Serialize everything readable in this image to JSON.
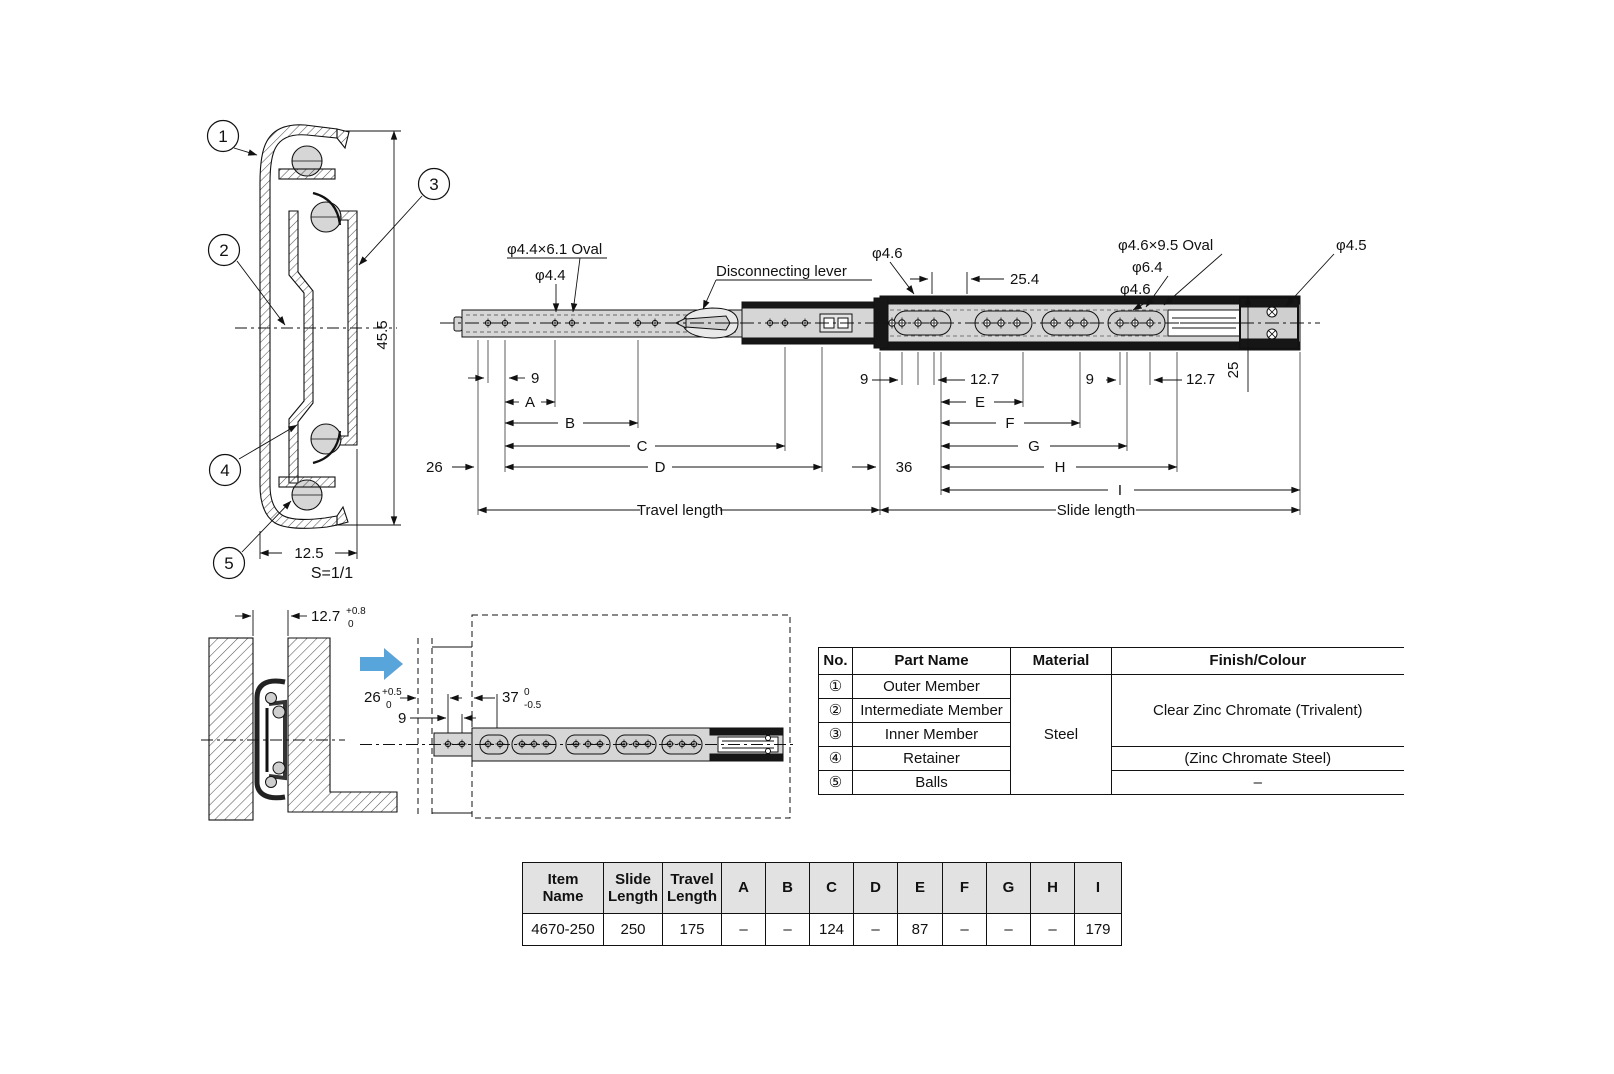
{
  "cross_section": {
    "balloons": [
      "1",
      "2",
      "3",
      "4",
      "5"
    ],
    "height_dim": "45.5",
    "width_dim": "12.5",
    "scale_note": "S=1/1"
  },
  "side_view": {
    "labels": {
      "oval_left": "φ4.4×6.1 Oval",
      "dia_left": "φ4.4",
      "lever": "Disconnecting lever",
      "dia_mid": "φ4.6",
      "pitch_mid": "25.4",
      "oval_right": "φ4.6×9.5 Oval",
      "dia_right_big": "φ6.4",
      "dia_right": "φ4.6",
      "dia_end": "φ4.5",
      "height_right": "25"
    },
    "left_dims": {
      "hole_offset": "9",
      "a": "A",
      "b": "B",
      "c": "C",
      "d": "D",
      "end_offset": "26",
      "total": "Travel length"
    },
    "right_dims": {
      "hole_offset": "9",
      "hole_pitch": "12.7",
      "e": "E",
      "f": "F",
      "g": "G",
      "h": "H",
      "end_offset": "36",
      "hole_offset2": "9",
      "hole_pitch2": "12.7",
      "i": "I",
      "total": "Slide length"
    }
  },
  "install_view": {
    "width_dim": "12.7",
    "tol_plus": "+0.8",
    "tol_minus": "0"
  },
  "compressed_view": {
    "depth_dim": "26",
    "depth_plus": "+0.5",
    "depth_minus": "0",
    "hole_offset": "9",
    "length_dim": "37",
    "length_plus": "0",
    "length_minus": "-0.5"
  },
  "parts_table": {
    "headers": [
      "No.",
      "Part Name",
      "Material",
      "Finish/Colour"
    ],
    "rows": [
      {
        "no": "①",
        "name": "Outer Member"
      },
      {
        "no": "②",
        "name": "Intermediate Member"
      },
      {
        "no": "③",
        "name": "Inner Member"
      },
      {
        "no": "④",
        "name": "Retainer"
      },
      {
        "no": "⑤",
        "name": "Balls"
      }
    ],
    "material": "Steel",
    "finish_1_3": "Clear Zinc Chromate (Trivalent)",
    "finish_4": "(Zinc Chromate Steel)",
    "finish_5": "–"
  },
  "dim_table": {
    "headers": [
      "Item Name",
      "Slide\nLength",
      "Travel\nLength",
      "A",
      "B",
      "C",
      "D",
      "E",
      "F",
      "G",
      "H",
      "I"
    ],
    "row": [
      "4670-250",
      "250",
      "175",
      "–",
      "–",
      "124",
      "–",
      "87",
      "–",
      "–",
      "–",
      "179"
    ]
  }
}
